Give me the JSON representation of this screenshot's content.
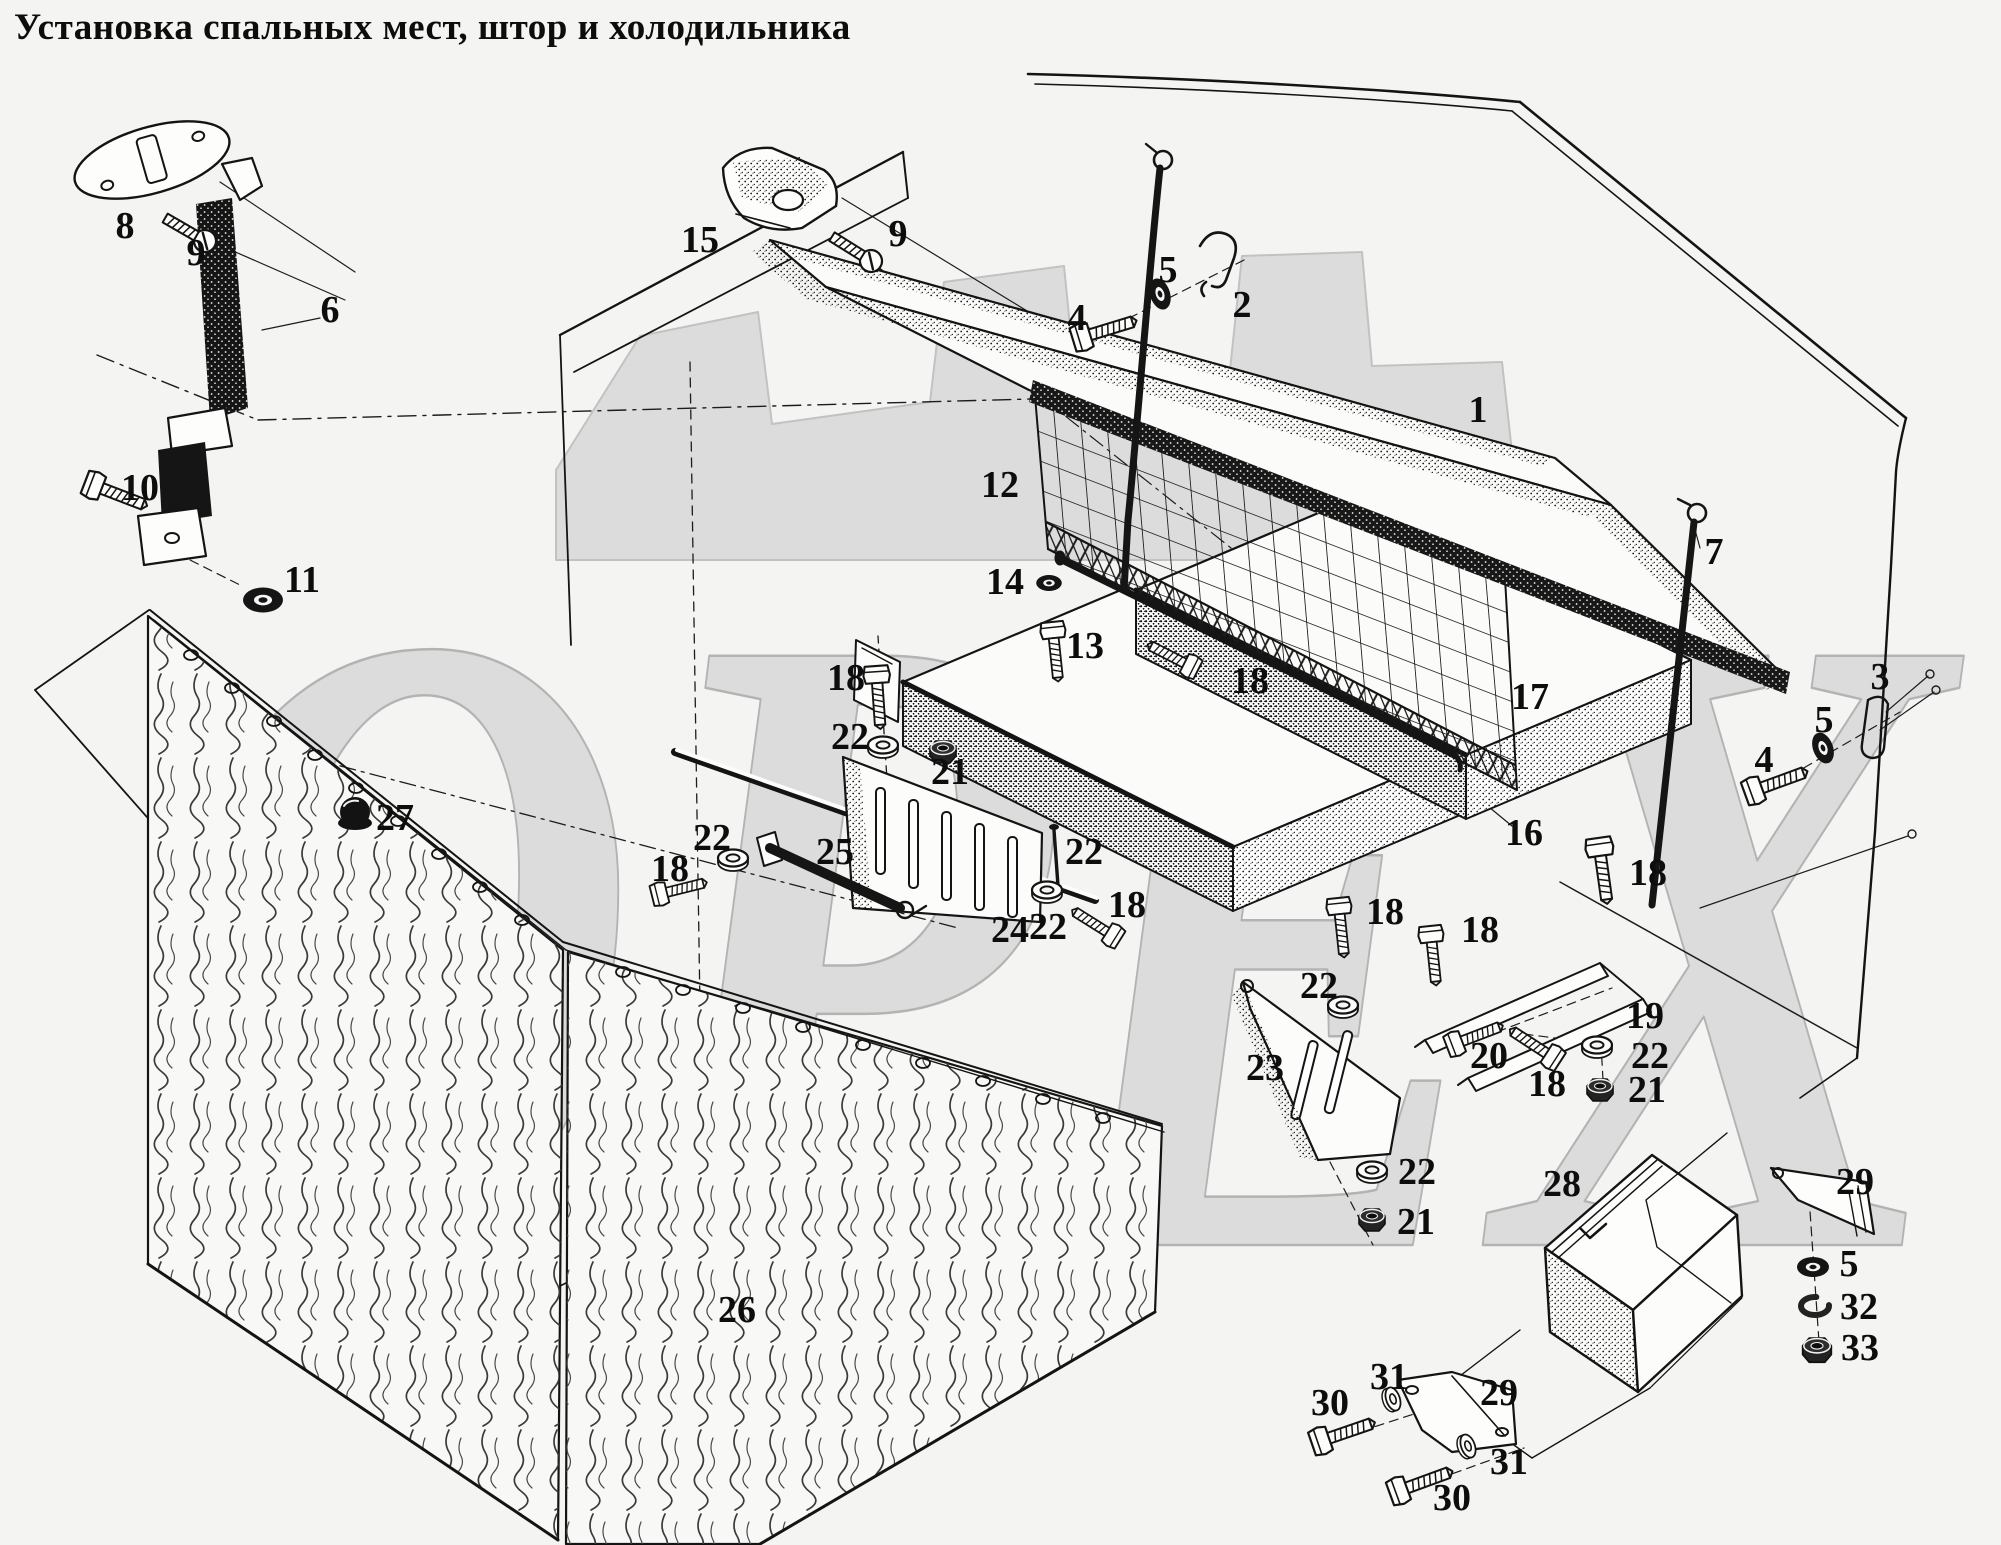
{
  "title": "Установка спальных мест, штор и холодильника",
  "watermark": {
    "text": "ОРЕХ"
  },
  "colors": {
    "background": "#f4f4f2",
    "ink": "#141414",
    "watermark_fill": "#dcdcdc",
    "watermark_stroke": "#b3b3b3"
  },
  "diagram": {
    "description": "Exploded parts view: sleeping berths, safety net, curtains and refrigerator installation",
    "labels": [
      {
        "n": "8",
        "x": 125,
        "y": 238
      },
      {
        "n": "9",
        "x": 196,
        "y": 265
      },
      {
        "n": "6",
        "x": 330,
        "y": 322
      },
      {
        "n": "10",
        "x": 140,
        "y": 500
      },
      {
        "n": "11",
        "x": 302,
        "y": 592
      },
      {
        "n": "15",
        "x": 700,
        "y": 252
      },
      {
        "n": "9",
        "x": 898,
        "y": 246
      },
      {
        "n": "4",
        "x": 1077,
        "y": 330
      },
      {
        "n": "5",
        "x": 1168,
        "y": 282
      },
      {
        "n": "2",
        "x": 1242,
        "y": 317
      },
      {
        "n": "1",
        "x": 1478,
        "y": 422
      },
      {
        "n": "7",
        "x": 1714,
        "y": 564
      },
      {
        "n": "12",
        "x": 1000,
        "y": 497
      },
      {
        "n": "14",
        "x": 1005,
        "y": 594
      },
      {
        "n": "13",
        "x": 1085,
        "y": 658
      },
      {
        "n": "18",
        "x": 1250,
        "y": 693
      },
      {
        "n": "17",
        "x": 1530,
        "y": 709
      },
      {
        "n": "3",
        "x": 1880,
        "y": 689
      },
      {
        "n": "5",
        "x": 1824,
        "y": 732
      },
      {
        "n": "4",
        "x": 1764,
        "y": 772
      },
      {
        "n": "16",
        "x": 1524,
        "y": 845
      },
      {
        "n": "18",
        "x": 1648,
        "y": 885
      },
      {
        "n": "18",
        "x": 846,
        "y": 690
      },
      {
        "n": "22",
        "x": 850,
        "y": 749
      },
      {
        "n": "21",
        "x": 950,
        "y": 784
      },
      {
        "n": "22",
        "x": 712,
        "y": 850
      },
      {
        "n": "18",
        "x": 670,
        "y": 881
      },
      {
        "n": "25",
        "x": 835,
        "y": 864
      },
      {
        "n": "27",
        "x": 395,
        "y": 830
      },
      {
        "n": "22",
        "x": 1084,
        "y": 864
      },
      {
        "n": "24",
        "x": 1010,
        "y": 942
      },
      {
        "n": "22",
        "x": 1048,
        "y": 939
      },
      {
        "n": "18",
        "x": 1127,
        "y": 917
      },
      {
        "n": "18",
        "x": 1385,
        "y": 924
      },
      {
        "n": "18",
        "x": 1480,
        "y": 942
      },
      {
        "n": "23",
        "x": 1265,
        "y": 1080
      },
      {
        "n": "22",
        "x": 1319,
        "y": 998
      },
      {
        "n": "19",
        "x": 1645,
        "y": 1028
      },
      {
        "n": "20",
        "x": 1489,
        "y": 1068
      },
      {
        "n": "22",
        "x": 1650,
        "y": 1068
      },
      {
        "n": "18",
        "x": 1547,
        "y": 1096
      },
      {
        "n": "21",
        "x": 1647,
        "y": 1102
      },
      {
        "n": "22",
        "x": 1417,
        "y": 1184
      },
      {
        "n": "21",
        "x": 1416,
        "y": 1234
      },
      {
        "n": "26",
        "x": 737,
        "y": 1322
      },
      {
        "n": "28",
        "x": 1562,
        "y": 1196
      },
      {
        "n": "29",
        "x": 1855,
        "y": 1194
      },
      {
        "n": "5",
        "x": 1849,
        "y": 1276
      },
      {
        "n": "32",
        "x": 1859,
        "y": 1319
      },
      {
        "n": "33",
        "x": 1860,
        "y": 1360
      },
      {
        "n": "31",
        "x": 1389,
        "y": 1389
      },
      {
        "n": "30",
        "x": 1330,
        "y": 1415
      },
      {
        "n": "29",
        "x": 1499,
        "y": 1405
      },
      {
        "n": "31",
        "x": 1509,
        "y": 1474
      },
      {
        "n": "30",
        "x": 1452,
        "y": 1510
      }
    ]
  }
}
